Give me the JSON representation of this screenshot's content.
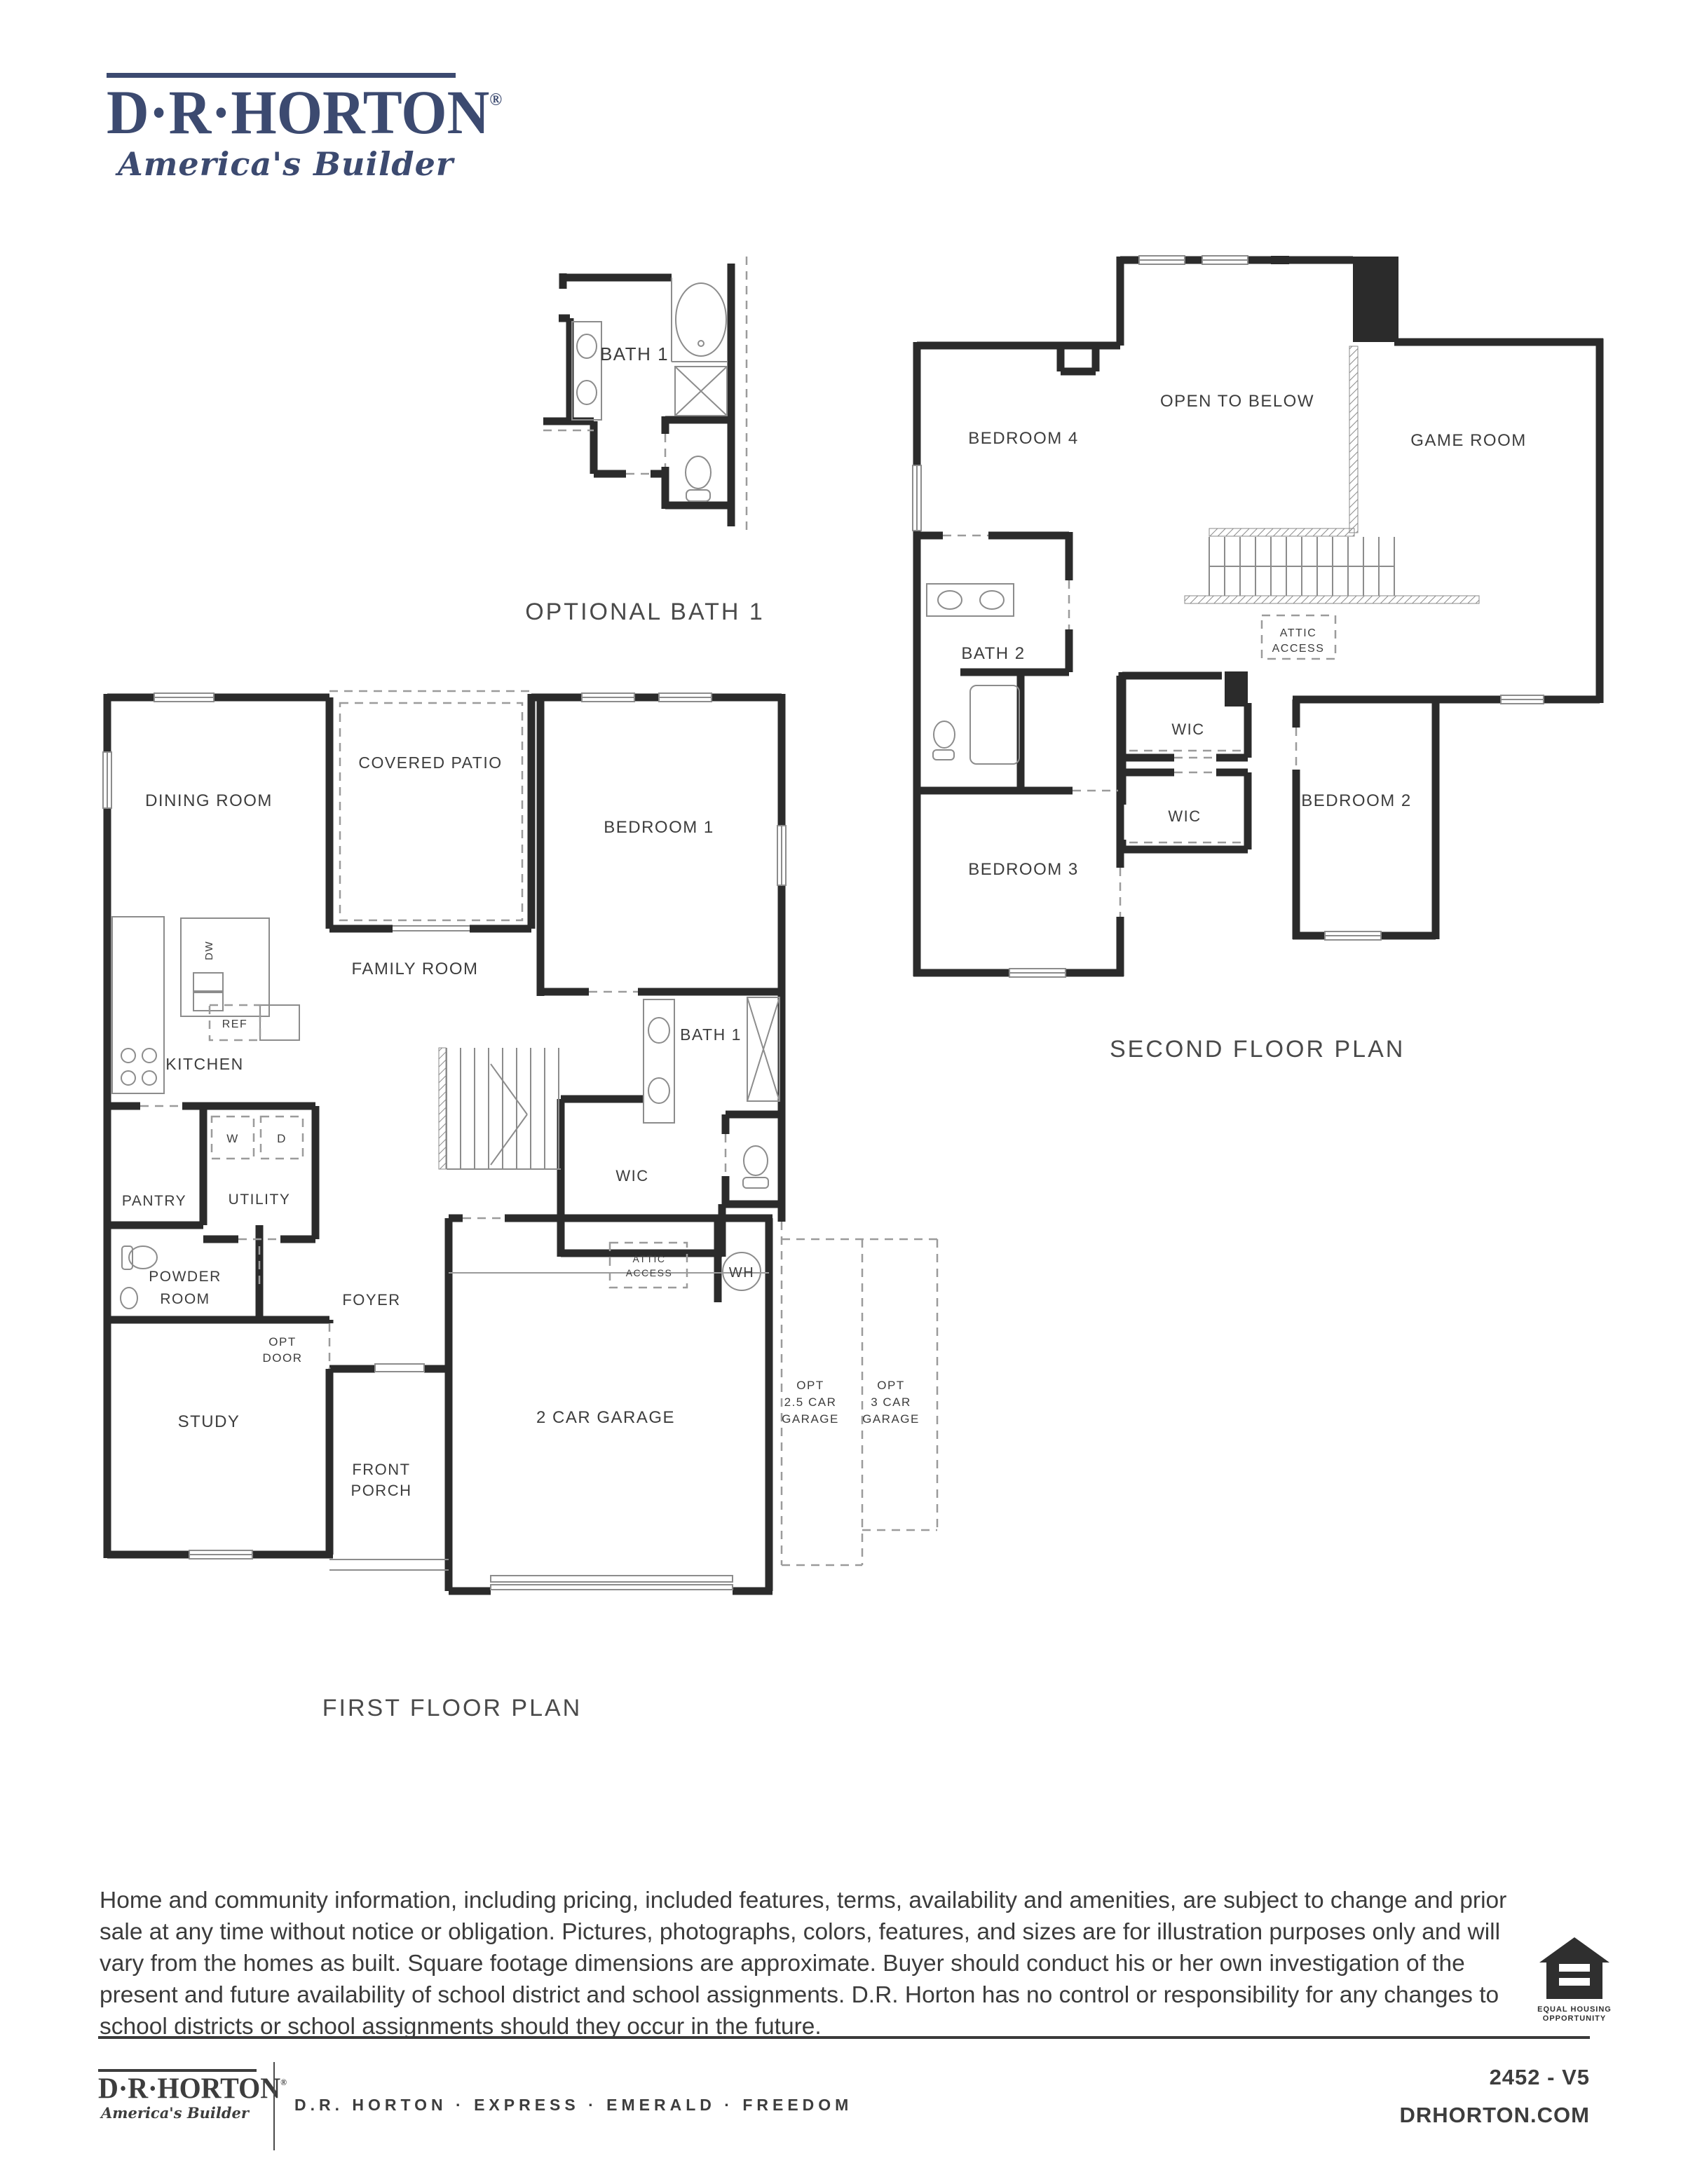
{
  "header": {
    "logo_text": "D·R·HORTON",
    "logo_registered": "®",
    "logo_tagline": "America's Builder"
  },
  "diagrams": {
    "optional_bath": {
      "title": "OPTIONAL BATH 1",
      "rooms": {
        "bath1": "BATH 1"
      }
    },
    "second_floor": {
      "title": "SECOND FLOOR PLAN",
      "rooms": {
        "bedroom4": "BEDROOM 4",
        "open_to_below": "OPEN TO BELOW",
        "game_room": "GAME ROOM",
        "attic_line1": "ATTIC",
        "attic_line2": "ACCESS",
        "bath2": "BATH 2",
        "wic_upper": "WIC",
        "wic_lower": "WIC",
        "bedroom2": "BEDROOM 2",
        "bedroom3": "BEDROOM 3"
      }
    },
    "first_floor": {
      "title": "FIRST FLOOR PLAN",
      "rooms": {
        "dining": "DINING ROOM",
        "covered_patio": "COVERED PATIO",
        "bedroom1": "BEDROOM 1",
        "family": "FAMILY ROOM",
        "kitchen": "KITCHEN",
        "dw": "DW",
        "ref": "REF",
        "washer": "W",
        "dryer": "D",
        "utility": "UTILITY",
        "pantry": "PANTRY",
        "powder_line1": "POWDER",
        "powder_line2": "ROOM",
        "bath1": "BATH 1",
        "wic": "WIC",
        "foyer": "FOYER",
        "attic_line1": "ATTIC",
        "attic_line2": "ACCESS",
        "wh": "WH",
        "study": "STUDY",
        "opt_door_line1": "OPT",
        "opt_door_line2": "DOOR",
        "porch_line1": "FRONT",
        "porch_line2": "PORCH",
        "garage": "2 CAR GARAGE",
        "opt25_line1": "OPT",
        "opt25_line2": "2.5 CAR",
        "opt25_line3": "GARAGE",
        "opt3_line1": "OPT",
        "opt3_line2": "3 CAR",
        "opt3_line3": "GARAGE"
      }
    }
  },
  "disclaimer": {
    "text": "Home and community information, including pricing, included features, terms, availability and amenities, are subject to change and prior sale at any time without notice or obligation. Pictures, photographs, colors, features, and sizes are for illustration purposes only and will vary from the homes as built.  Square footage dimensions are approximate. Buyer should conduct his or her own investigation of the present and future availability of school district and school assignments.  D.R. Horton has no control or responsibility for any changes to school districts or school assignments should they occur in the future."
  },
  "equal_housing": {
    "line1": "EQUAL HOUSING",
    "line2": "OPPORTUNITY"
  },
  "footer": {
    "logo_text": "D·R·HORTON",
    "logo_registered": "®",
    "logo_tagline": "America's Builder",
    "brands": "D.R. HORTON · EXPRESS · EMERALD · FREEDOM",
    "plan_number": "2452 - V5",
    "website": "DRHORTON.COM"
  }
}
